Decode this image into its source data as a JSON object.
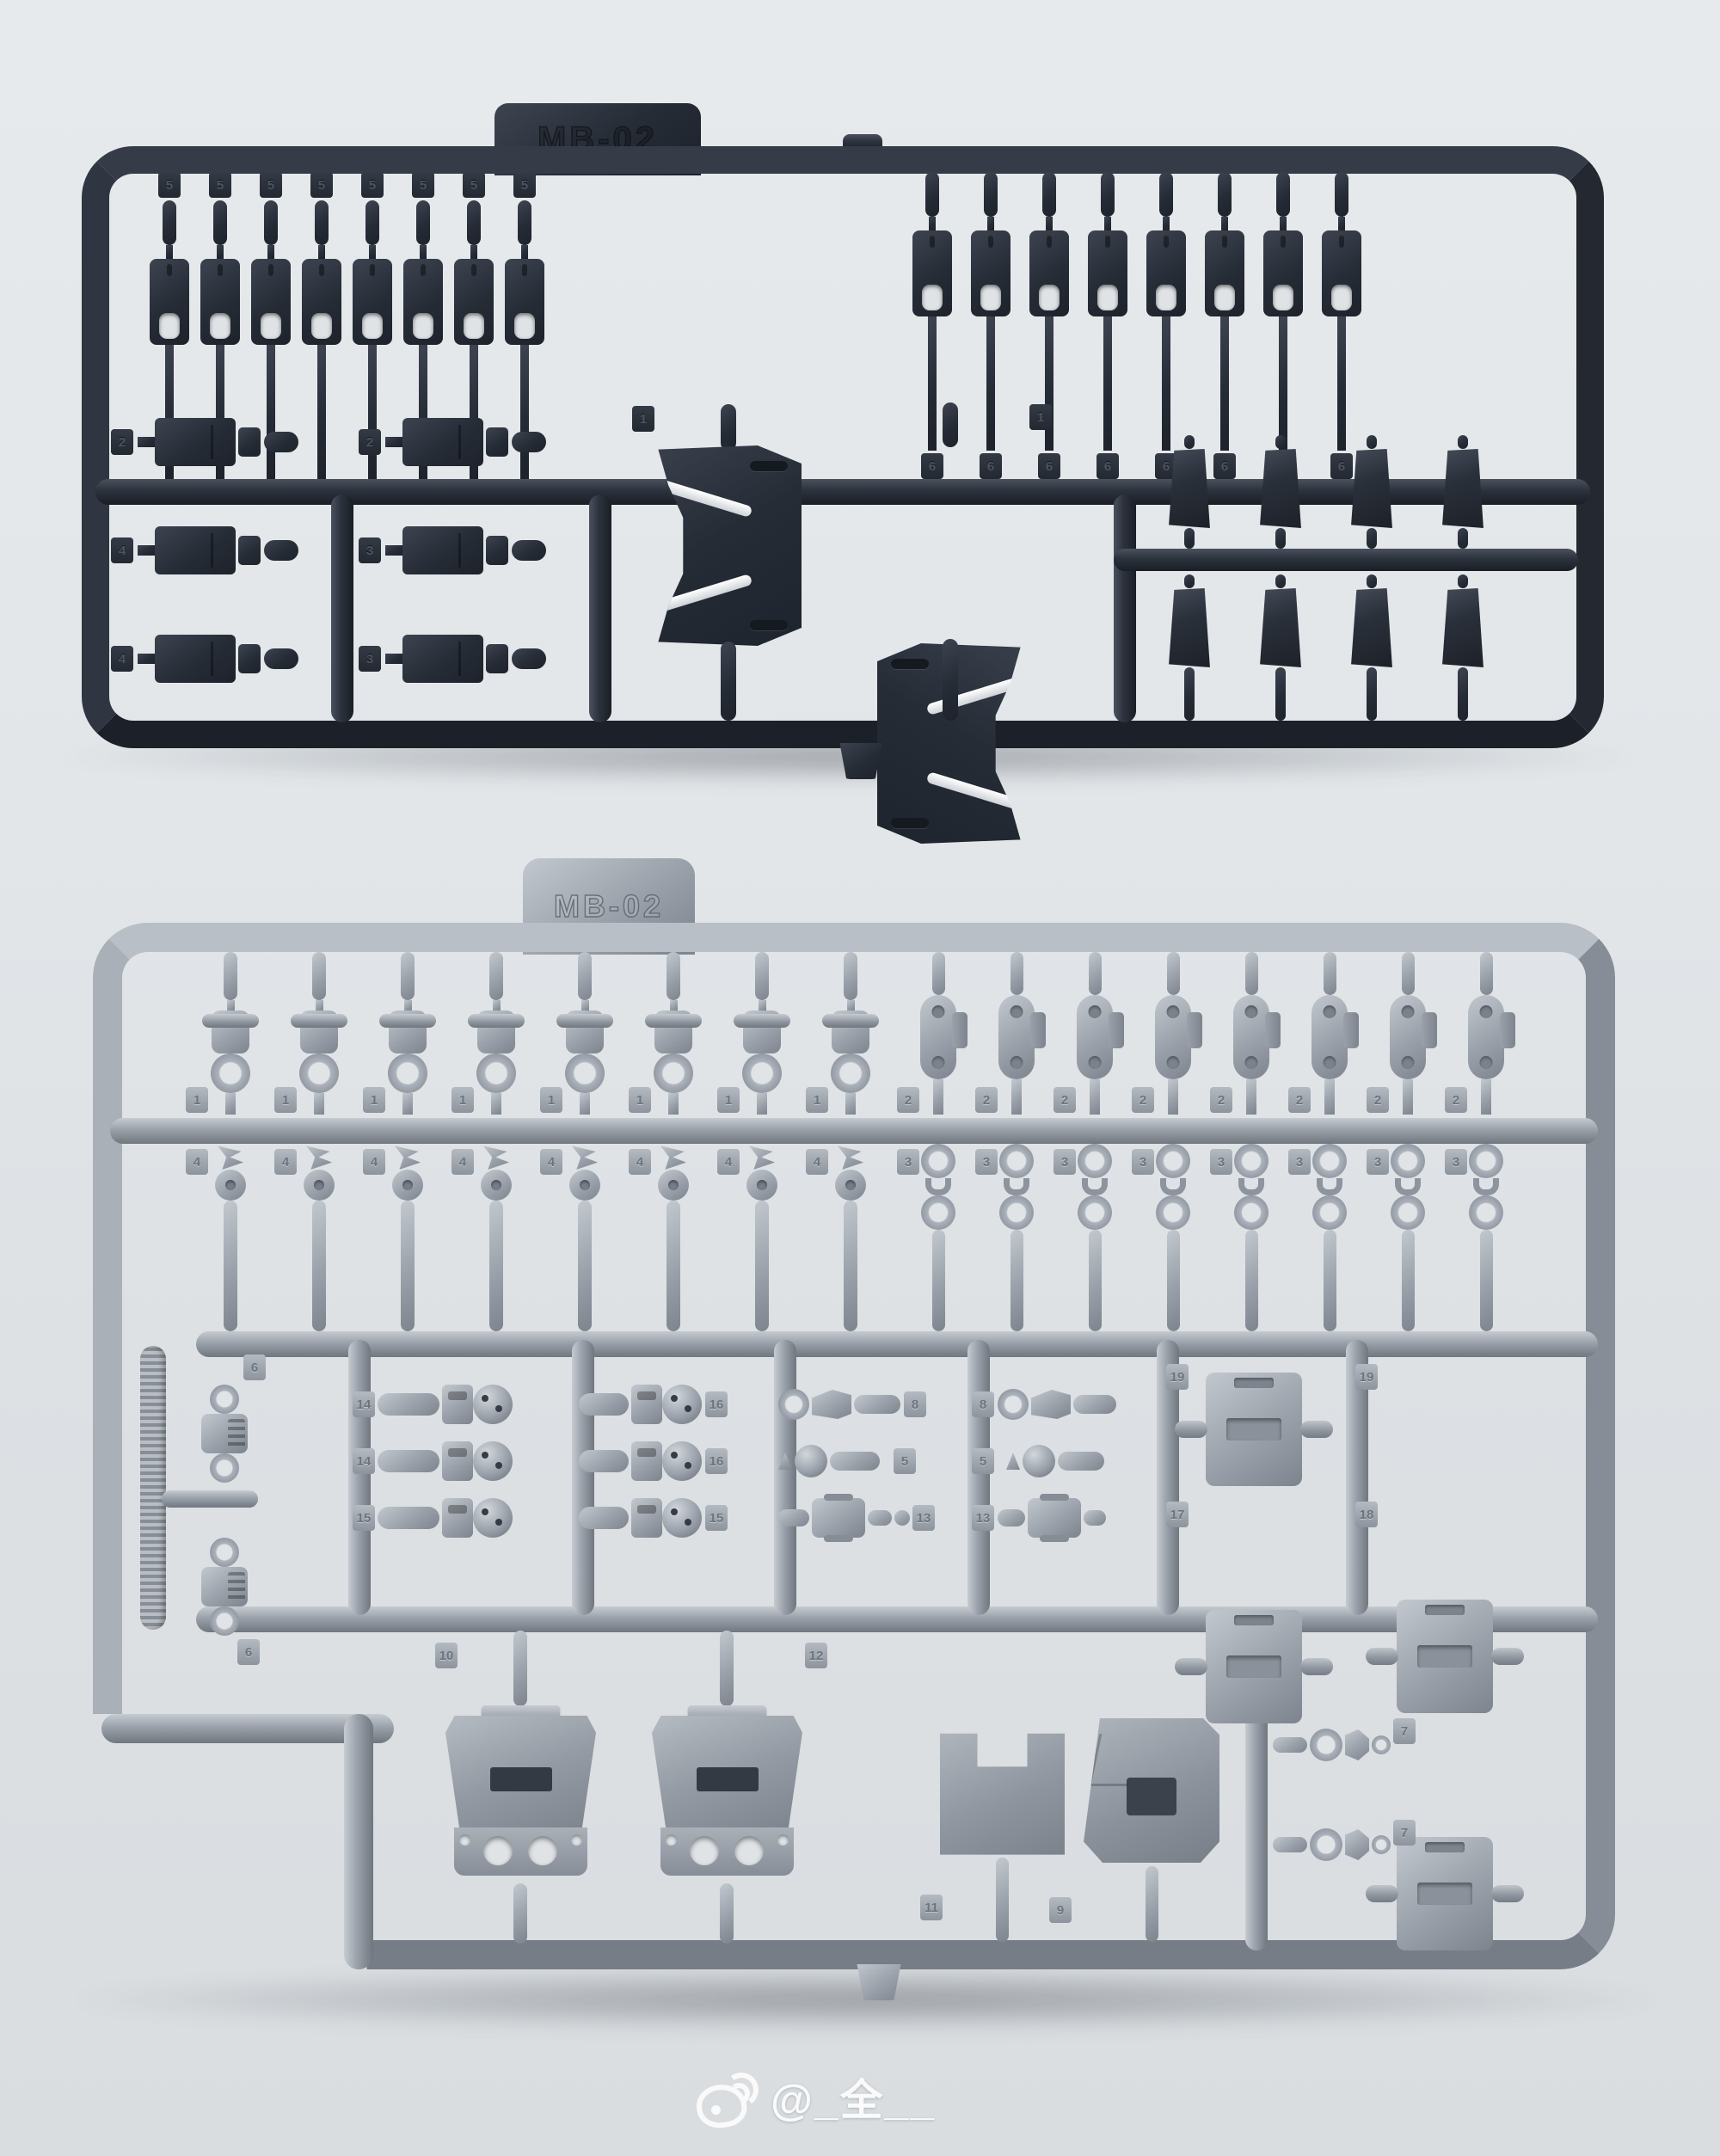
{
  "photo": {
    "description": "Two injection-molded model-kit part runners (sprues) coded MB-02, upper one in dark navy plastic, lower one in light gray plastic, photographed on a pale studio background",
    "watermark": {
      "platform": "weibo",
      "handle": "@_全__"
    }
  },
  "colors": {
    "background": "#e2e6e9",
    "dark_plastic": "#2b313b",
    "light_plastic": "#9aa1aa"
  },
  "sprue_dark": {
    "code": "MB-02",
    "top_left_tags": [
      "5",
      "5",
      "5",
      "5",
      "5",
      "5",
      "5",
      "5"
    ],
    "top_right_tags": [
      "6",
      "6",
      "6",
      "6",
      "6",
      "6",
      "6",
      "6"
    ],
    "left_col_a_tags": [
      "2",
      "4",
      "4"
    ],
    "left_col_b_tags": [
      "2",
      "3",
      "3"
    ],
    "box_tags": [
      "1",
      "1"
    ]
  },
  "sprue_light": {
    "code": "MB-02",
    "row1_upper_tags": [
      "1",
      "1",
      "1",
      "1",
      "1",
      "1",
      "1",
      "1"
    ],
    "row1_lower_tags": [
      "4",
      "4",
      "4",
      "4",
      "4",
      "4",
      "4",
      "4"
    ],
    "row2_upper_tags": [
      "2",
      "2",
      "2",
      "2",
      "2",
      "2",
      "2",
      "2"
    ],
    "row2_lower_tags": [
      "3",
      "3",
      "3",
      "3",
      "3",
      "3",
      "3",
      "3"
    ],
    "strip_tags": [
      "6",
      "6"
    ],
    "grid_a_tags": [
      "14",
      "14",
      "15"
    ],
    "grid_b_tags": [
      "16",
      "16",
      "15"
    ],
    "grid_c_tags": [
      "8",
      "5",
      "13"
    ],
    "grid_d_tags": [
      "8",
      "5",
      "13"
    ],
    "grid_e_tags": [
      "19",
      "17"
    ],
    "grid_f_tags": [
      "19",
      "18"
    ],
    "bottom_tags": {
      "backpack": "10",
      "mid": "12",
      "armor_left": "11",
      "armor_right": "9"
    },
    "joint_tags": [
      "7",
      "7"
    ]
  }
}
